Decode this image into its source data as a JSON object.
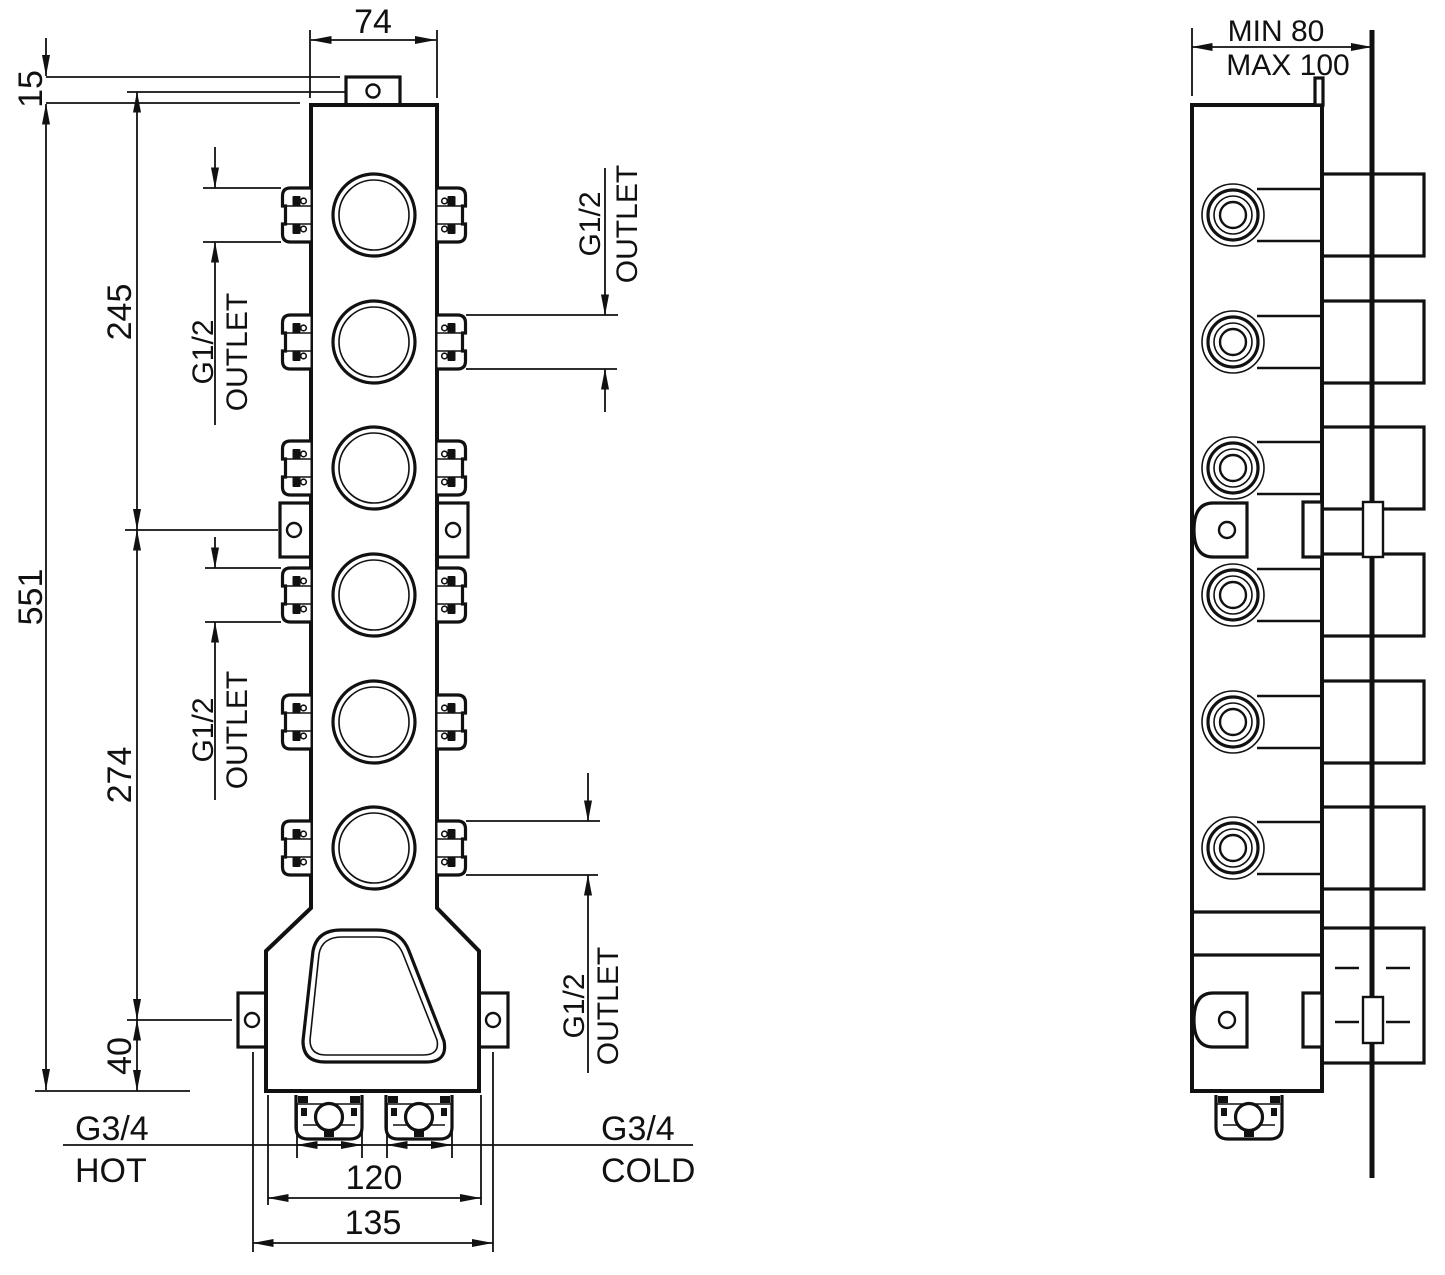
{
  "front": {
    "dim_width": "74",
    "dim_offset": "15",
    "dim_height": "551",
    "dim_upper": "245",
    "dim_lower": "274",
    "dim_bottom": "40",
    "dim_inlet_span": "120",
    "dim_tab_span": "135",
    "outlet_size": "G1/2",
    "outlet_label": "OUTLET",
    "inlet_size": "G3/4",
    "inlet_hot": "HOT",
    "inlet_cold": "COLD"
  },
  "side": {
    "depth_min": "MIN 80",
    "depth_max": "MAX 100"
  },
  "colors": {
    "line": "#111111",
    "background": "#ffffff"
  }
}
